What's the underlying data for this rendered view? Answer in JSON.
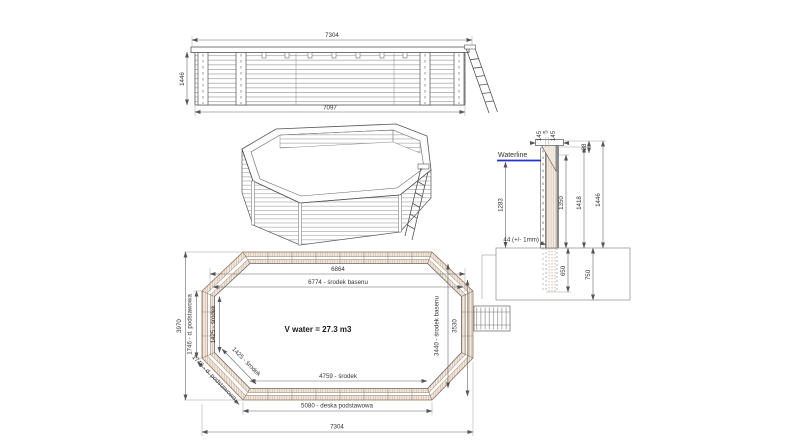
{
  "drawing_title": "wooden octagonal pool technical drawing",
  "colors": {
    "line": "#555555",
    "dim": "#666666",
    "wood_hatch": "#c9ac93",
    "wood_bg": "#f2e9df",
    "waterline_blue": "#2233cc",
    "dark_liner": "#8a8a8a"
  },
  "elevation": {
    "dim_top": "7304",
    "dim_left": "1446",
    "dim_bottom": "7097"
  },
  "section": {
    "waterline_label": "Waterline",
    "dim_cap_left": "145",
    "dim_cap_mid": "5",
    "dim_cap_right": "145",
    "dim_cap_h": "28",
    "dim_depth": "1283",
    "dim_plank": "44 (+/- 1mm)",
    "dim_1350": "1350",
    "dim_1418": "1418",
    "dim_1446": "1446",
    "dim_650": "650",
    "dim_750": "750"
  },
  "plan": {
    "dim_6864": "6864",
    "dim_6774": "6774 - środek basenu",
    "dim_3970": "3970",
    "dim_1746_left": "1746 - d. podstawowa",
    "dim_1425_left": "1425 - środek",
    "dim_1425_diag": "1425 - środek",
    "dim_1746_diag": "1746 - d. podstawowa",
    "dim_3440": "3440 - środek basenu",
    "dim_3530": "3530",
    "volume": "V water = 27.3 m3",
    "dim_4759": "4759 - środek",
    "dim_5080": "5080 - deska podstawowa",
    "dim_7304": "7304"
  }
}
